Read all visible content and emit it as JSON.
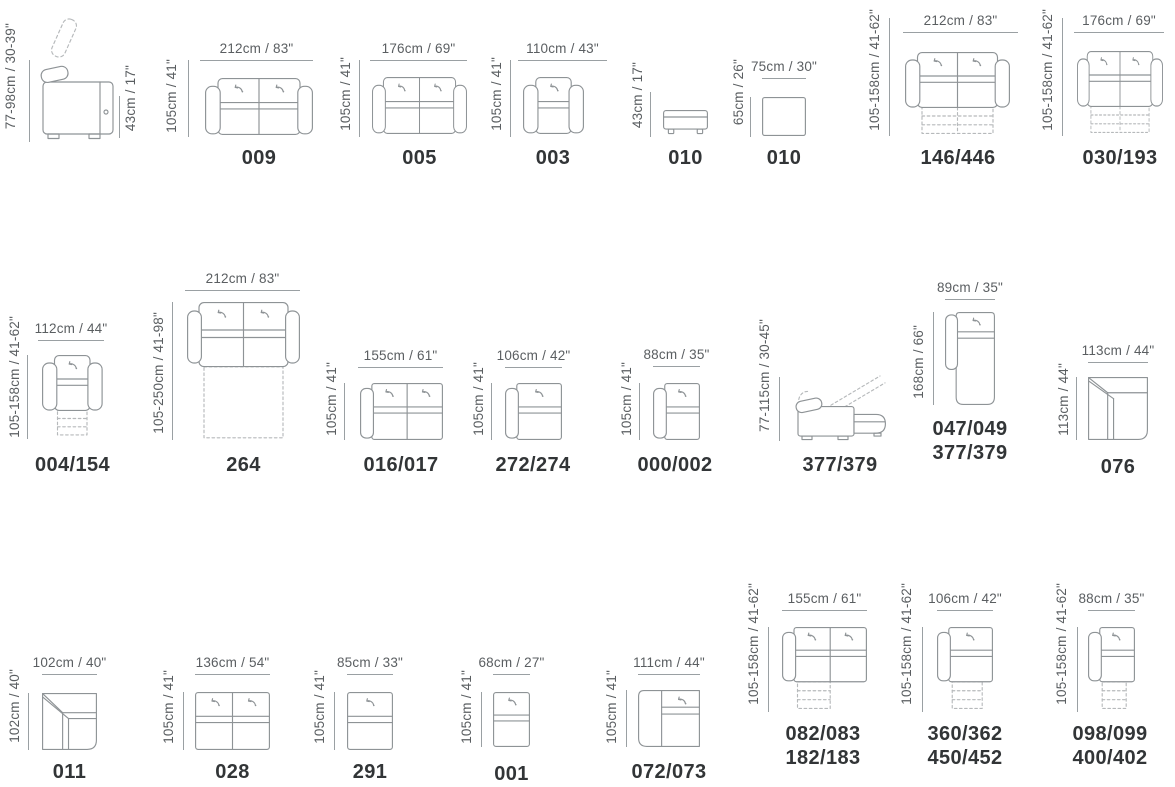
{
  "page": {
    "background": "#ffffff"
  },
  "colors": {
    "dimension_line": "#9aa0a3",
    "dimension_text": "#5a5e61",
    "model_text": "#323537",
    "drawing_stroke": "#8e9396",
    "dashed_stroke": "#b6b9bb"
  },
  "items": [
    {
      "type": "sofa-side-view",
      "left_dim": "77-98cm / 30-39\"",
      "right_dim": "43cm / 17\""
    },
    {
      "type": "two-seat-sofa",
      "top_dim": "212cm / 83\"",
      "left_dim": "105cm / 41\"",
      "model": "009"
    },
    {
      "type": "two-seat-sofa",
      "top_dim": "176cm / 69\"",
      "left_dim": "105cm / 41\"",
      "model": "005"
    },
    {
      "type": "armchair",
      "top_dim": "110cm / 43\"",
      "left_dim": "105cm / 41\"",
      "model": "003"
    },
    {
      "type": "ottoman-side-view",
      "left_dim": "43cm / 17\"",
      "model": "010"
    },
    {
      "type": "ottoman-top-view",
      "top_dim": "75cm / 30\"",
      "left_dim": "65cm / 26\"",
      "model": "010"
    },
    {
      "type": "two-seat-recliner-sofa",
      "top_dim": "212cm / 83\"",
      "left_dim": "105-158cm / 41-62\"",
      "model": "146/446"
    },
    {
      "type": "two-seat-recliner-sofa",
      "top_dim": "176cm / 69\"",
      "left_dim": "105-158cm / 41-62\"",
      "model": "030/193"
    },
    {
      "type": "recliner-armchair",
      "top_dim": "112cm / 44\"",
      "left_dim": "105-158cm / 41-62\"",
      "model": "004/154"
    },
    {
      "type": "sofa-bed",
      "top_dim": "212cm / 83\"",
      "left_dim": "105-250cm / 41-98\"",
      "model": "264"
    },
    {
      "type": "two-seat-left-arm-module",
      "top_dim": "155cm / 61\"",
      "left_dim": "105cm / 41\"",
      "model": "016/017"
    },
    {
      "type": "one-seat-left-arm-module",
      "top_dim": "106cm / 42\"",
      "left_dim": "105cm / 41\"",
      "model": "272/274"
    },
    {
      "type": "one-seat-left-arm-module",
      "top_dim": "88cm / 35\"",
      "left_dim": "105cm / 41\"",
      "model": "000/002"
    },
    {
      "type": "recliner-side-view",
      "left_dim": "77-115cm / 30-45\"",
      "model": "377/379"
    },
    {
      "type": "chaise-module",
      "top_dim": "89cm / 35\"",
      "left_dim": "168cm / 66\"",
      "model": "047/049",
      "model2": "377/379"
    },
    {
      "type": "corner-module",
      "top_dim": "113cm / 44\"",
      "left_dim": "113cm / 44\"",
      "model": "076"
    },
    {
      "type": "corner-module",
      "top_dim": "102cm / 40\"",
      "left_dim": "102cm / 40\"",
      "model": "011"
    },
    {
      "type": "two-seat-armless-module",
      "top_dim": "136cm / 54\"",
      "left_dim": "105cm / 41\"",
      "model": "028"
    },
    {
      "type": "one-seat-armless-module",
      "top_dim": "85cm / 33\"",
      "left_dim": "105cm / 41\"",
      "model": "291"
    },
    {
      "type": "one-seat-armless-module",
      "top_dim": "68cm / 27\"",
      "left_dim": "105cm / 41\"",
      "model": "001"
    },
    {
      "type": "corner-terminal-module",
      "top_dim": "111cm / 44\"",
      "left_dim": "105cm / 41\"",
      "model": "072/073"
    },
    {
      "type": "two-seat-left-arm-recliner",
      "top_dim": "155cm / 61\"",
      "left_dim": "105-158cm / 41-62\"",
      "model": "082/083",
      "model2": "182/183"
    },
    {
      "type": "one-seat-left-arm-recliner",
      "top_dim": "106cm / 42\"",
      "left_dim": "105-158cm / 41-62\"",
      "model": "360/362",
      "model2": "450/452"
    },
    {
      "type": "one-seat-left-arm-recliner",
      "top_dim": "88cm / 35\"",
      "left_dim": "105-158cm / 41-62\"",
      "model": "098/099",
      "model2": "400/402"
    }
  ]
}
